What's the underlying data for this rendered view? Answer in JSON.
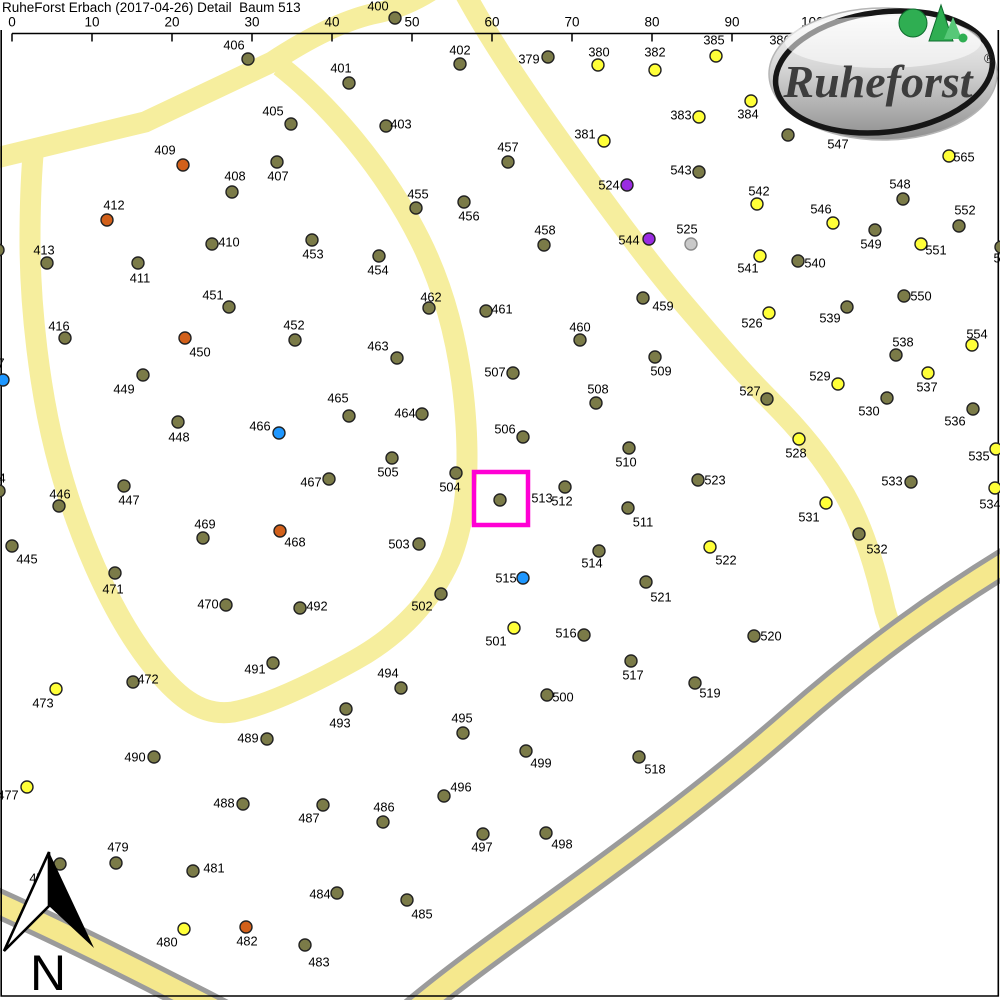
{
  "header": {
    "title": "RuheForst Erbach (2017-04-26) Detail  Baum 513"
  },
  "scalebar": {
    "y": 33.5,
    "x0": 12,
    "dx": 80,
    "tick_len": 8,
    "labels": [
      "0",
      "10",
      "20",
      "30",
      "40",
      "50",
      "60",
      "70",
      "80",
      "90",
      "100m"
    ]
  },
  "logo": {
    "text": "Ruheforst",
    "registered": "®"
  },
  "north": {
    "letter": "N"
  },
  "selection": {
    "tree": "513",
    "x": 474,
    "y": 472,
    "w": 54,
    "h": 53,
    "color": "#ff00d4"
  },
  "colors": {
    "o": "#7b7b48",
    "y": "#ffff38",
    "r": "#d2601a",
    "b": "#1e97ff",
    "p": "#9a2ce2",
    "g": "#c9c9c9",
    "pale": "#f6ee9e",
    "hwy": "#f5e88d",
    "gray": "#9b9b9b",
    "selection": "#ff00d4",
    "dot_stroke": "#222222"
  },
  "roads": [
    {
      "name": "road-top-left",
      "d": "M -12 160 L 145 122 L 272 62 Q 330 24 372 14 Q 405 8 435 -12",
      "color": "pale",
      "w": 21
    },
    {
      "name": "road-loop",
      "d": "M 280 66 C 330 105 385 170 420 240 C 448 296 462 360 466 425 C 469 475 466 520 450 560 C 432 600 400 635 355 660 C 310 685 265 706 233 712 C 200 717 175 695 148 660 C 110 610 75 530 55 450 C 40 390 30 310 30 240 C 30 205 31 180 33 155",
      "color": "pale",
      "w": 21
    },
    {
      "name": "road-main-diagonal",
      "d": "M 462 -12 C 495 50 545 120 585 175 C 625 230 655 270 685 305 C 715 340 740 370 770 400 C 800 430 825 460 845 495 C 862 525 875 565 885 610 L 892 632",
      "color": "pale",
      "w": 21
    },
    {
      "name": "highway-casing-east",
      "d": "M 1016 556 C 940 602 870 652 790 722 C 710 792 620 858 545 912 C 495 948 448 982 408 1016",
      "color": "gray",
      "w": 30
    },
    {
      "name": "highway-casing-west",
      "d": "M -14 898 C 40 922 110 956 180 992 C 212 1008 242 1024 264 1036",
      "color": "gray",
      "w": 30
    },
    {
      "name": "highway-fill-east",
      "d": "M 1016 556 C 940 602 870 652 790 722 C 710 792 620 858 545 912 C 495 948 448 982 408 1016",
      "color": "hwy",
      "w": 20
    },
    {
      "name": "highway-fill-west",
      "d": "M -14 898 C 40 922 110 956 180 992 C 212 1008 242 1024 264 1036",
      "color": "hwy",
      "w": 20
    }
  ],
  "trees": [
    {
      "n": "379",
      "x": 548,
      "y": 57,
      "c": "o",
      "lx": 529,
      "ly": 59
    },
    {
      "n": "380",
      "x": 598,
      "y": 65,
      "c": "y",
      "lx": 599,
      "ly": 52
    },
    {
      "n": "381",
      "x": 604,
      "y": 141,
      "c": "y",
      "lx": 585,
      "ly": 134
    },
    {
      "n": "382",
      "x": 655,
      "y": 70,
      "c": "y",
      "lx": 655,
      "ly": 52
    },
    {
      "n": "383",
      "x": 699,
      "y": 117,
      "c": "y",
      "lx": 681,
      "ly": 115
    },
    {
      "n": "384",
      "x": 751,
      "y": 101,
      "c": "y",
      "lx": 748,
      "ly": 114
    },
    {
      "n": "385",
      "x": 716,
      "y": 56,
      "c": "y",
      "lx": 714,
      "ly": 40
    },
    {
      "n": "386",
      "lx": 780,
      "ly": 40
    },
    {
      "n": "400",
      "x": 395,
      "y": 18,
      "c": "o",
      "lx": 378,
      "ly": 6
    },
    {
      "n": "401",
      "x": 349,
      "y": 83,
      "c": "o",
      "lx": 341,
      "ly": 68
    },
    {
      "n": "402",
      "x": 460,
      "y": 64,
      "c": "o",
      "lx": 460,
      "ly": 50
    },
    {
      "n": "403",
      "x": 386,
      "y": 126,
      "c": "o",
      "lx": 401,
      "ly": 124
    },
    {
      "n": "405",
      "x": 291,
      "y": 124,
      "c": "o",
      "lx": 273,
      "ly": 111
    },
    {
      "n": "406",
      "x": 248,
      "y": 59,
      "c": "o",
      "lx": 234,
      "ly": 45
    },
    {
      "n": "407",
      "x": 277,
      "y": 162,
      "c": "o",
      "lx": 278,
      "ly": 176
    },
    {
      "n": "408",
      "x": 232,
      "y": 192,
      "c": "o",
      "lx": 235,
      "ly": 176
    },
    {
      "n": "409",
      "x": 183,
      "y": 165,
      "c": "r",
      "lx": 165,
      "ly": 150
    },
    {
      "n": "410",
      "x": 212,
      "y": 244,
      "c": "o",
      "lx": 229,
      "ly": 242
    },
    {
      "n": "411",
      "x": 138,
      "y": 263,
      "c": "o",
      "lx": 140,
      "ly": 278
    },
    {
      "n": "412",
      "x": 107,
      "y": 220,
      "c": "r",
      "lx": 114,
      "ly": 205
    },
    {
      "n": "413",
      "x": 47,
      "y": 263,
      "c": "o",
      "lx": 44,
      "ly": 250
    },
    {
      "n": "416",
      "x": 65,
      "y": 338,
      "c": "o",
      "lx": 59,
      "ly": 326
    },
    {
      "n": "445",
      "x": 12,
      "y": 546,
      "c": "o",
      "lx": 27,
      "ly": 559
    },
    {
      "n": "446",
      "x": 59,
      "y": 506,
      "c": "o",
      "lx": 60,
      "ly": 494
    },
    {
      "n": "447",
      "x": 124,
      "y": 486,
      "c": "o",
      "lx": 129,
      "ly": 500
    },
    {
      "n": "448",
      "x": 178,
      "y": 422,
      "c": "o",
      "lx": 179,
      "ly": 437
    },
    {
      "n": "449",
      "x": 143,
      "y": 375,
      "c": "o",
      "lx": 124,
      "ly": 389
    },
    {
      "n": "450",
      "x": 185,
      "y": 338,
      "c": "r",
      "lx": 200,
      "ly": 352
    },
    {
      "n": "451",
      "x": 229,
      "y": 307,
      "c": "o",
      "lx": 213,
      "ly": 295
    },
    {
      "n": "452",
      "x": 295,
      "y": 340,
      "c": "o",
      "lx": 294,
      "ly": 325
    },
    {
      "n": "453",
      "x": 312,
      "y": 240,
      "c": "o",
      "lx": 313,
      "ly": 254
    },
    {
      "n": "454",
      "x": 379,
      "y": 256,
      "c": "o",
      "lx": 378,
      "ly": 270
    },
    {
      "n": "455",
      "x": 416,
      "y": 208,
      "c": "o",
      "lx": 418,
      "ly": 194
    },
    {
      "n": "456",
      "x": 464,
      "y": 202,
      "c": "o",
      "lx": 469,
      "ly": 216
    },
    {
      "n": "457",
      "x": 508,
      "y": 162,
      "c": "o",
      "lx": 508,
      "ly": 147
    },
    {
      "n": "458",
      "x": 544,
      "y": 245,
      "c": "o",
      "lx": 545,
      "ly": 230
    },
    {
      "n": "459",
      "x": 643,
      "y": 298,
      "c": "o",
      "lx": 663,
      "ly": 306
    },
    {
      "n": "460",
      "x": 580,
      "y": 340,
      "c": "o",
      "lx": 580,
      "ly": 327
    },
    {
      "n": "461",
      "x": 486,
      "y": 311,
      "c": "o",
      "lx": 502,
      "ly": 309
    },
    {
      "n": "462",
      "x": 429,
      "y": 308,
      "c": "o",
      "lx": 431,
      "ly": 297
    },
    {
      "n": "463",
      "x": 397,
      "y": 358,
      "c": "o",
      "lx": 378,
      "ly": 346
    },
    {
      "n": "464",
      "x": 422,
      "y": 414,
      "c": "o",
      "lx": 405,
      "ly": 413
    },
    {
      "n": "465",
      "x": 349,
      "y": 416,
      "c": "o",
      "lx": 338,
      "ly": 398
    },
    {
      "n": "466",
      "x": 279,
      "y": 433,
      "c": "b",
      "lx": 260,
      "ly": 426
    },
    {
      "n": "467",
      "x": 329,
      "y": 479,
      "c": "o",
      "lx": 311,
      "ly": 482
    },
    {
      "n": "468",
      "x": 280,
      "y": 531,
      "c": "r",
      "lx": 295,
      "ly": 542
    },
    {
      "n": "469",
      "x": 203,
      "y": 538,
      "c": "o",
      "lx": 205,
      "ly": 524
    },
    {
      "n": "470",
      "x": 226,
      "y": 605,
      "c": "o",
      "lx": 208,
      "ly": 604
    },
    {
      "n": "471",
      "x": 115,
      "y": 573,
      "c": "o",
      "lx": 113,
      "ly": 589
    },
    {
      "n": "472",
      "x": 133,
      "y": 682,
      "c": "o",
      "lx": 148,
      "ly": 679
    },
    {
      "n": "473",
      "x": 56,
      "y": 689,
      "c": "y",
      "lx": 43,
      "ly": 703
    },
    {
      "n": "477",
      "x": 27,
      "y": 787,
      "c": "y",
      "lx": 8,
      "ly": 795
    },
    {
      "n": "478",
      "x": 60,
      "y": 864,
      "c": "o",
      "lx": 40,
      "ly": 878
    },
    {
      "n": "479",
      "x": 116,
      "y": 863,
      "c": "o",
      "lx": 118,
      "ly": 847
    },
    {
      "n": "480",
      "x": 184,
      "y": 929,
      "c": "y",
      "lx": 167,
      "ly": 942
    },
    {
      "n": "481",
      "x": 193,
      "y": 871,
      "c": "o",
      "lx": 214,
      "ly": 868
    },
    {
      "n": "482",
      "x": 246,
      "y": 927,
      "c": "r",
      "lx": 247,
      "ly": 941
    },
    {
      "n": "483",
      "x": 305,
      "y": 945,
      "c": "o",
      "lx": 319,
      "ly": 962
    },
    {
      "n": "484",
      "x": 337,
      "y": 893,
      "c": "o",
      "lx": 320,
      "ly": 894
    },
    {
      "n": "485",
      "x": 407,
      "y": 900,
      "c": "o",
      "lx": 422,
      "ly": 914
    },
    {
      "n": "486",
      "x": 383,
      "y": 822,
      "c": "o",
      "lx": 384,
      "ly": 807
    },
    {
      "n": "487",
      "x": 323,
      "y": 805,
      "c": "o",
      "lx": 309,
      "ly": 818
    },
    {
      "n": "488",
      "x": 243,
      "y": 804,
      "c": "o",
      "lx": 224,
      "ly": 803
    },
    {
      "n": "489",
      "x": 267,
      "y": 739,
      "c": "o",
      "lx": 248,
      "ly": 738
    },
    {
      "n": "490",
      "x": 154,
      "y": 757,
      "c": "o",
      "lx": 135,
      "ly": 757
    },
    {
      "n": "491",
      "x": 273,
      "y": 663,
      "c": "o",
      "lx": 255,
      "ly": 669
    },
    {
      "n": "492",
      "x": 300,
      "y": 608,
      "c": "o",
      "lx": 317,
      "ly": 606
    },
    {
      "n": "493",
      "x": 346,
      "y": 709,
      "c": "o",
      "lx": 340,
      "ly": 723
    },
    {
      "n": "494",
      "x": 401,
      "y": 688,
      "c": "o",
      "lx": 388,
      "ly": 673
    },
    {
      "n": "495",
      "x": 463,
      "y": 733,
      "c": "o",
      "lx": 462,
      "ly": 718
    },
    {
      "n": "496",
      "x": 444,
      "y": 796,
      "c": "o",
      "lx": 461,
      "ly": 787
    },
    {
      "n": "497",
      "x": 483,
      "y": 834,
      "c": "o",
      "lx": 482,
      "ly": 847
    },
    {
      "n": "498",
      "x": 546,
      "y": 833,
      "c": "o",
      "lx": 562,
      "ly": 844
    },
    {
      "n": "499",
      "x": 526,
      "y": 751,
      "c": "o",
      "lx": 541,
      "ly": 763
    },
    {
      "n": "500",
      "x": 547,
      "y": 695,
      "c": "o",
      "lx": 563,
      "ly": 697
    },
    {
      "n": "501",
      "x": 514,
      "y": 628,
      "c": "y",
      "lx": 496,
      "ly": 641
    },
    {
      "n": "502",
      "x": 441,
      "y": 594,
      "c": "o",
      "lx": 422,
      "ly": 606
    },
    {
      "n": "503",
      "x": 419,
      "y": 544,
      "c": "o",
      "lx": 399,
      "ly": 544
    },
    {
      "n": "504",
      "x": 456,
      "y": 473,
      "c": "o",
      "lx": 450,
      "ly": 487
    },
    {
      "n": "505",
      "x": 392,
      "y": 458,
      "c": "o",
      "lx": 388,
      "ly": 472
    },
    {
      "n": "506",
      "x": 523,
      "y": 437,
      "c": "o",
      "lx": 505,
      "ly": 429
    },
    {
      "n": "507",
      "x": 513,
      "y": 373,
      "c": "o",
      "lx": 495,
      "ly": 372
    },
    {
      "n": "508",
      "x": 596,
      "y": 403,
      "c": "o",
      "lx": 598,
      "ly": 389
    },
    {
      "n": "509",
      "x": 655,
      "y": 357,
      "c": "o",
      "lx": 661,
      "ly": 371
    },
    {
      "n": "510",
      "x": 629,
      "y": 448,
      "c": "o",
      "lx": 626,
      "ly": 462
    },
    {
      "n": "511",
      "x": 628,
      "y": 508,
      "c": "o",
      "lx": 643,
      "ly": 522
    },
    {
      "n": "512",
      "x": 565,
      "y": 487,
      "c": "o",
      "lx": 562,
      "ly": 501
    },
    {
      "n": "513",
      "x": 500,
      "y": 500,
      "c": "o",
      "lx": 542,
      "ly": 498
    },
    {
      "n": "514",
      "x": 599,
      "y": 551,
      "c": "o",
      "lx": 592,
      "ly": 563
    },
    {
      "n": "515",
      "x": 523,
      "y": 578,
      "c": "b",
      "lx": 506,
      "ly": 578
    },
    {
      "n": "516",
      "x": 584,
      "y": 635,
      "c": "o",
      "lx": 566,
      "ly": 633
    },
    {
      "n": "517",
      "x": 631,
      "y": 661,
      "c": "o",
      "lx": 633,
      "ly": 675
    },
    {
      "n": "518",
      "x": 639,
      "y": 757,
      "c": "o",
      "lx": 655,
      "ly": 769
    },
    {
      "n": "519",
      "x": 695,
      "y": 683,
      "c": "o",
      "lx": 710,
      "ly": 693
    },
    {
      "n": "520",
      "x": 754,
      "y": 636,
      "c": "o",
      "lx": 771,
      "ly": 636
    },
    {
      "n": "521",
      "x": 646,
      "y": 582,
      "c": "o",
      "lx": 661,
      "ly": 597
    },
    {
      "n": "522",
      "x": 710,
      "y": 547,
      "c": "y",
      "lx": 726,
      "ly": 560
    },
    {
      "n": "523",
      "x": 698,
      "y": 480,
      "c": "o",
      "lx": 715,
      "ly": 480
    },
    {
      "n": "524",
      "x": 627,
      "y": 185,
      "c": "p",
      "lx": 609,
      "ly": 185
    },
    {
      "n": "525",
      "x": 691,
      "y": 244,
      "c": "g",
      "lx": 687,
      "ly": 229
    },
    {
      "n": "526",
      "x": 769,
      "y": 313,
      "c": "y",
      "lx": 752,
      "ly": 323
    },
    {
      "n": "527",
      "x": 767,
      "y": 399,
      "c": "o",
      "lx": 750,
      "ly": 391
    },
    {
      "n": "528",
      "x": 799,
      "y": 439,
      "c": "y",
      "lx": 796,
      "ly": 453
    },
    {
      "n": "529",
      "x": 838,
      "y": 384,
      "c": "y",
      "lx": 820,
      "ly": 376
    },
    {
      "n": "530",
      "x": 887,
      "y": 398,
      "c": "o",
      "lx": 869,
      "ly": 411
    },
    {
      "n": "531",
      "x": 826,
      "y": 503,
      "c": "y",
      "lx": 809,
      "ly": 517
    },
    {
      "n": "532",
      "x": 859,
      "y": 534,
      "c": "o",
      "lx": 877,
      "ly": 549
    },
    {
      "n": "533",
      "x": 911,
      "y": 482,
      "c": "o",
      "lx": 892,
      "ly": 481
    },
    {
      "n": "534",
      "x": 995,
      "y": 488,
      "c": "y",
      "lx": 990,
      "ly": 504
    },
    {
      "n": "535",
      "x": 996,
      "y": 449,
      "c": "y",
      "lx": 979,
      "ly": 456
    },
    {
      "n": "536",
      "x": 973,
      "y": 409,
      "c": "o",
      "lx": 955,
      "ly": 421
    },
    {
      "n": "537",
      "x": 928,
      "y": 373,
      "c": "y",
      "lx": 927,
      "ly": 387
    },
    {
      "n": "538",
      "x": 896,
      "y": 355,
      "c": "o",
      "lx": 903,
      "ly": 342
    },
    {
      "n": "539",
      "x": 847,
      "y": 307,
      "c": "o",
      "lx": 830,
      "ly": 318
    },
    {
      "n": "540",
      "x": 798,
      "y": 261,
      "c": "o",
      "lx": 815,
      "ly": 263
    },
    {
      "n": "541",
      "x": 760,
      "y": 256,
      "c": "y",
      "lx": 748,
      "ly": 268
    },
    {
      "n": "542",
      "x": 757,
      "y": 204,
      "c": "y",
      "lx": 759,
      "ly": 191
    },
    {
      "n": "543",
      "x": 699,
      "y": 172,
      "c": "o",
      "lx": 681,
      "ly": 170
    },
    {
      "n": "544",
      "x": 649,
      "y": 239,
      "c": "p",
      "lx": 629,
      "ly": 240
    },
    {
      "n": "546",
      "x": 833,
      "y": 223,
      "c": "y",
      "lx": 821,
      "ly": 209
    },
    {
      "n": "547",
      "x": 788,
      "y": 135,
      "c": "o",
      "lx": 838,
      "ly": 144
    },
    {
      "n": "548",
      "x": 903,
      "y": 199,
      "c": "o",
      "lx": 900,
      "ly": 184
    },
    {
      "n": "549",
      "x": 875,
      "y": 230,
      "c": "o",
      "lx": 871,
      "ly": 244
    },
    {
      "n": "550",
      "x": 904,
      "y": 296,
      "c": "o",
      "lx": 921,
      "ly": 296
    },
    {
      "n": "551",
      "x": 921,
      "y": 244,
      "c": "y",
      "lx": 936,
      "ly": 250
    },
    {
      "n": "552",
      "x": 959,
      "y": 226,
      "c": "o",
      "lx": 965,
      "ly": 210
    },
    {
      "n": "554",
      "x": 972,
      "y": 345,
      "c": "y",
      "lx": 977,
      "ly": 334
    },
    {
      "n": "565",
      "x": 949,
      "y": 156,
      "c": "y",
      "lx": 964,
      "ly": 157
    },
    {
      "n": "",
      "x": -2,
      "y": 250,
      "c": "o"
    },
    {
      "n": "7",
      "x": 3,
      "y": 380,
      "c": "b",
      "lx": 1,
      "ly": 363
    },
    {
      "n": "4",
      "x": -1,
      "y": 491,
      "c": "o",
      "lx": 2,
      "ly": 478
    },
    {
      "n": "5",
      "x": 1001,
      "y": 247,
      "c": "o",
      "lx": 997,
      "ly": 258
    }
  ]
}
